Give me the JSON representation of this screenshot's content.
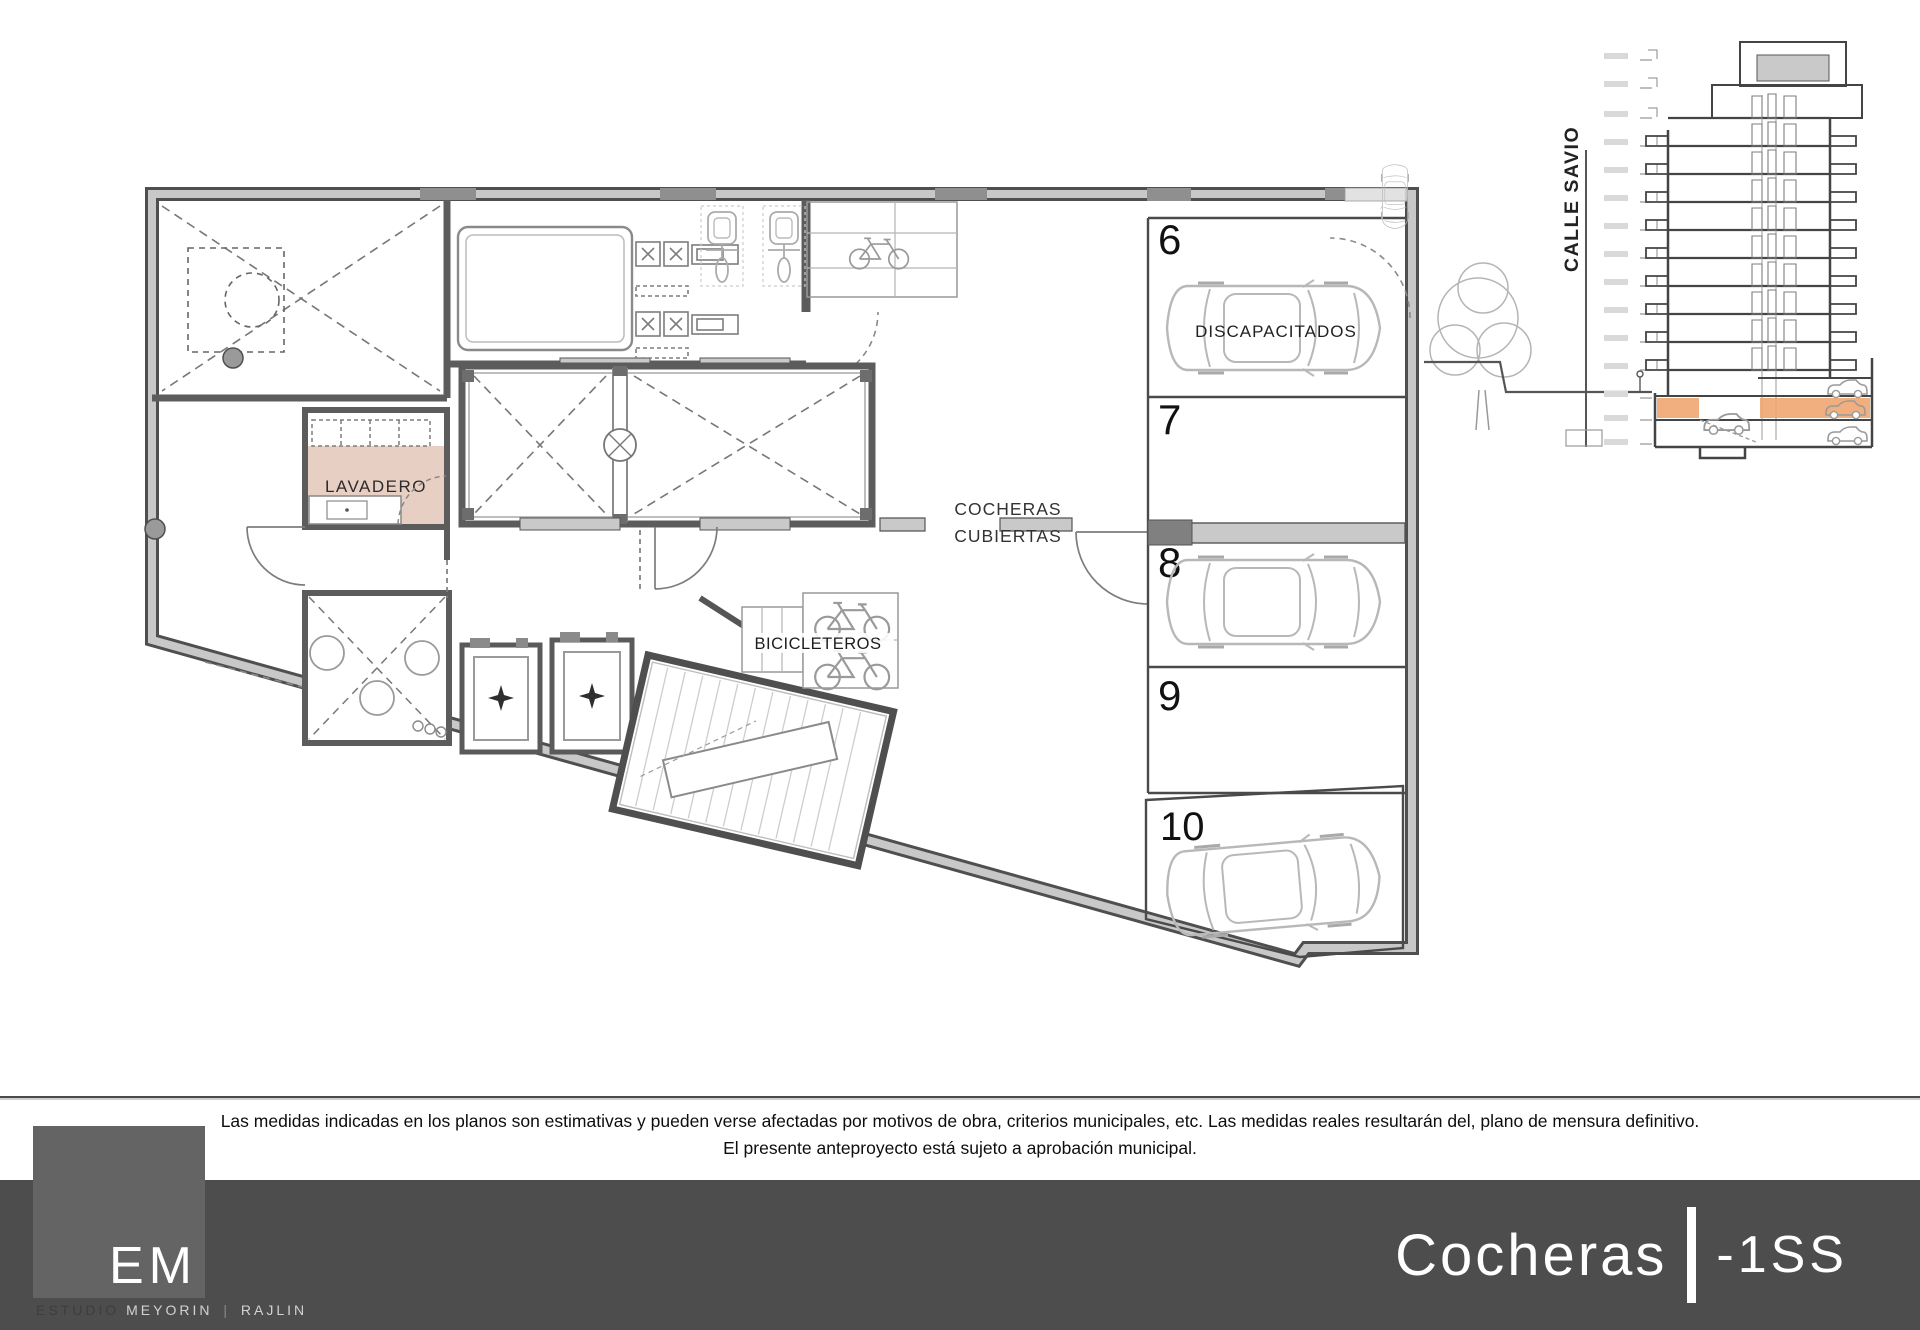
{
  "plan": {
    "room_labels": {
      "lavadero": "LAVADERO",
      "cocheras_line1": "COCHERAS",
      "cocheras_line2": "CUBIERTAS",
      "bicicleteros": "BICICLETEROS"
    },
    "parking": {
      "spaces": [
        {
          "number": "6",
          "label": "DISCAPACITADOS",
          "has_car": true
        },
        {
          "number": "7",
          "label": "",
          "has_car": false
        },
        {
          "number": "8",
          "label": "",
          "has_car": true
        },
        {
          "number": "9",
          "label": "",
          "has_car": false
        },
        {
          "number": "10",
          "label": "",
          "has_car": true
        }
      ]
    }
  },
  "section": {
    "street_label": "CALLE SAVIO"
  },
  "disclaimer": {
    "line1": "Las medidas indicadas en los planos son estimativas y pueden verse afectadas por motivos de obra, criterios municipales, etc. Las medidas reales resultarán del, plano de mensura definitivo.",
    "line2": "El presente anteproyecto está sujeto a aprobación municipal."
  },
  "footer": {
    "title": "Cocheras",
    "separator": "|",
    "level": "-1SS"
  },
  "logo": {
    "monogram": "EM",
    "sub": {
      "word1": "ESTUDIO",
      "word2": "MEYORIN",
      "sep": "|",
      "word3": "RAJLIN"
    }
  },
  "colors": {
    "wall_dark": "#4f4f4f",
    "wall_light": "#c8c8c8",
    "lavadero_fill": "#e8cfc4",
    "section_highlight": "#f0a571",
    "footer_bar": "#4d4d4d",
    "logo_square": "#646464"
  }
}
